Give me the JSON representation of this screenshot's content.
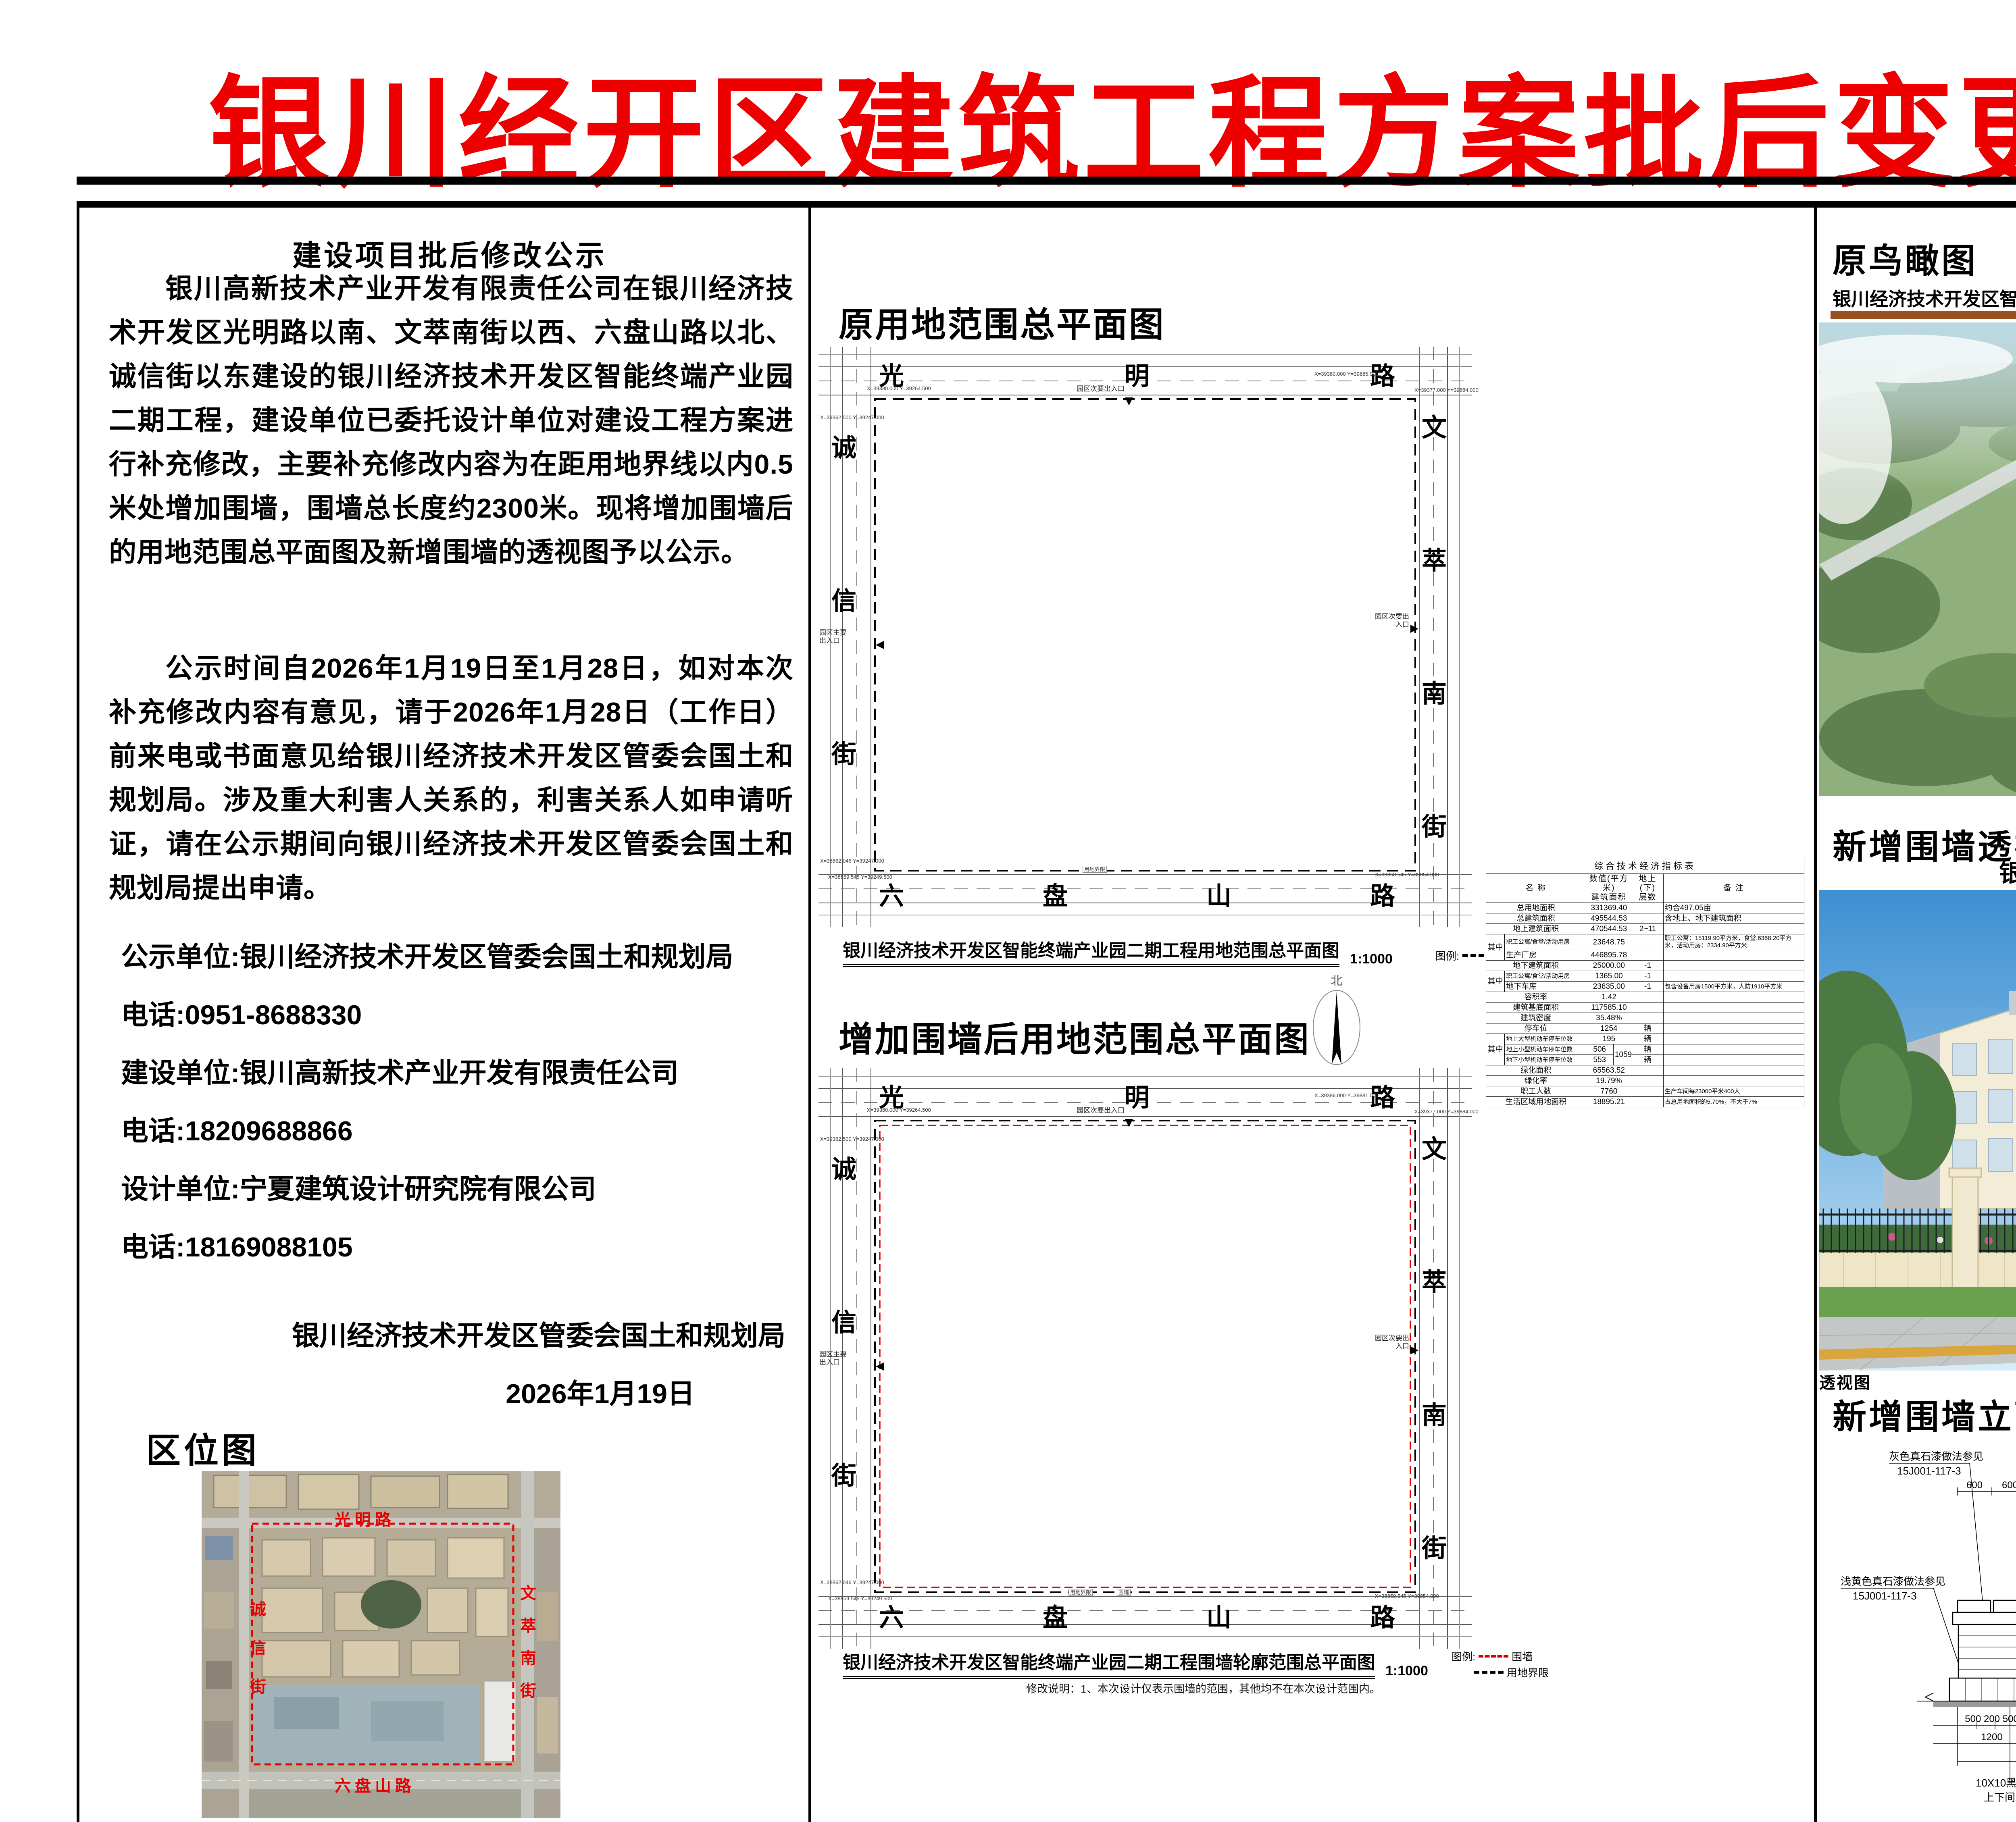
{
  "title": "银川经开区建筑工程方案批后变更公示图",
  "roads": {
    "guangming": "光明路",
    "chengxin": "诚信街",
    "wencui": "文萃南街",
    "liupanshan": "六盘山路"
  },
  "left": {
    "notice_title": "建设项目批后修改公示",
    "para1": "银川高新技术产业开发有限责任公司在银川经济技术开发区光明路以南、文萃南街以西、六盘山路以北、诚信街以东建设的银川经济技术开发区智能终端产业园二期工程，建设单位已委托设计单位对建设工程方案进行补充修改，主要补充修改内容为在距用地界线以内0.5米处增加围墙，围墙总长度约2300米。现将增加围墙后的用地范围总平面图及新增围墙的透视图予以公示。",
    "para2": "公示时间自2026年1月19日至1月28日，如对本次补充修改内容有意见，请于2026年1月28日（工作日）前来电或书面意见给银川经济技术开发区管委会国土和规划局。涉及重大利害人关系的，利害关系人如申请听证，请在公示期间向银川经济技术开发区管委会国土和规划局提出申请。",
    "publisher": "公示单位:银川经济技术开发区管委会国土和规划局",
    "publisher_tel": "电话:0951-8688330",
    "builder": "建设单位:银川高新技术产业开发有限责任公司",
    "builder_tel": "电话:18209688866",
    "designer": "设计单位:宁夏建筑设计研究院有限公司",
    "designer_tel": "电话:18169088105",
    "signoff_org": "银川经济技术开发区管委会国土和规划局",
    "signoff_date": "2026年1月19日",
    "locmap_heading": "区位图"
  },
  "plan1": {
    "heading": "原用地范围总平面图",
    "caption": "银川经济技术开发区智能终端产业园二期工程用地范围总平面图",
    "scale": "1:1000",
    "legend_label": "图例:",
    "legend_boundary": "用地界限",
    "entrance_top": "园区次要出入口",
    "entrance_right": "园区次要出入口",
    "entrance_left": "园区主要出入口",
    "boundary_label": "用地界限",
    "coord_tl": "X=39380.000 Y=39264.500",
    "coord_tl2": "X=39362.500 Y=39247.000",
    "coord_tr": "X=39380.000 Y=39885.000",
    "coord_tr2": "X=39377.000 Y=39884.000",
    "coord_bl": "X=38862.046 Y=39247.000",
    "coord_bl2": "X=38859.545 Y=39249.500",
    "coord_br": "X=38858.545 Y=39854.000"
  },
  "north_label": "北",
  "plan2": {
    "heading": "增加围墙后用地范围总平面图",
    "caption": "银川经济技术开发区智能终端产业园二期工程围墙轮廓范围总平面图",
    "scale": "1:1000",
    "legend_label": "图例:",
    "legend_wall": "围墙",
    "legend_boundary": "用地界限",
    "note": "修改说明：1、本次设计仅表示围墙的范围，其他均不在本次设计范围内。",
    "wall_label": "围墙",
    "entrance_top": "园区次要出入口",
    "entrance_right": "园区次要出入口",
    "entrance_left": "园区主要出入口",
    "boundary_label": "用地界限",
    "coord_tl": "X=39380.000 Y=39264.500",
    "coord_tl2": "X=39362.500 Y=39247.000",
    "coord_tr": "X=39386.000 Y=39881.000",
    "coord_tr2": "X=39377.000 Y=39884.000",
    "coord_bl": "X=38862.046 Y=39247.000",
    "coord_bl2": "X=38859.545 Y=39249.500",
    "coord_br": "X=38859.545 Y=39854.000"
  },
  "indicator_table": {
    "title": "综合技术经济指标表",
    "h_name": "名    称",
    "h_value": "数值(平方米)\n建筑面积",
    "h_floors": "地上(下)\n层数",
    "h_remark": "备    注",
    "rows": [
      [
        {
          "t": "总用地面积",
          "cs": 2
        },
        {
          "t": "331369.40",
          "cs": 2
        },
        {
          "t": ""
        },
        {
          "t": "约合497.05亩",
          "al": "l"
        }
      ],
      [
        {
          "t": "总建筑面积",
          "cs": 2
        },
        {
          "t": "495544.53",
          "cs": 2
        },
        {
          "t": ""
        },
        {
          "t": "含地上、地下建筑面积",
          "al": "l"
        }
      ],
      [
        {
          "t": "地上建筑面积",
          "cs": 2
        },
        {
          "t": "470544.53",
          "cs": 2
        },
        {
          "t": "2~11"
        },
        {
          "t": ""
        }
      ],
      [
        {
          "t": "其中",
          "rs": 2
        },
        {
          "t": "职工公寓/食堂/活动用房",
          "al": "l",
          "cls": "small"
        },
        {
          "t": "23648.75",
          "cs": 2
        },
        {
          "t": ""
        },
        {
          "t": "职工公寓：15119.90平方米，食堂:6368.20平方米，活动用房：2334.90平方米.",
          "al": "l",
          "cls": "small"
        }
      ],
      [
        {
          "t": "生产厂房",
          "al": "l"
        },
        {
          "t": "446895.78",
          "cs": 2
        },
        {
          "t": ""
        },
        {
          "t": ""
        }
      ],
      [
        {
          "t": "地下建筑面积",
          "cs": 2
        },
        {
          "t": "25000.00",
          "cs": 2
        },
        {
          "t": "-1"
        },
        {
          "t": ""
        }
      ],
      [
        {
          "t": "其中",
          "rs": 2
        },
        {
          "t": "职工公寓/食堂/活动用房",
          "al": "l",
          "cls": "small"
        },
        {
          "t": "1365.00",
          "cs": 2
        },
        {
          "t": "-1"
        },
        {
          "t": ""
        }
      ],
      [
        {
          "t": "地下车库",
          "al": "l"
        },
        {
          "t": "23635.00",
          "cs": 2
        },
        {
          "t": "-1"
        },
        {
          "t": "包含设备用房1500平方米，人防1910平方米",
          "al": "l",
          "cls": "small"
        }
      ],
      [
        {
          "t": "容积率",
          "cs": 2
        },
        {
          "t": "1.42",
          "cs": 2
        },
        {
          "t": ""
        },
        {
          "t": ""
        }
      ],
      [
        {
          "t": "建筑基底面积",
          "cs": 2
        },
        {
          "t": "117585.10",
          "cs": 2
        },
        {
          "t": ""
        },
        {
          "t": ""
        }
      ],
      [
        {
          "t": "建筑密度",
          "cs": 2
        },
        {
          "t": "35.48%",
          "cs": 2
        },
        {
          "t": ""
        },
        {
          "t": ""
        }
      ],
      [
        {
          "t": "停车位",
          "cs": 2
        },
        {
          "t": "1254",
          "cs": 2
        },
        {
          "t": "辆"
        },
        {
          "t": ""
        }
      ],
      [
        {
          "t": "其中",
          "rs": 3
        },
        {
          "t": "地上大型机动车停车位数",
          "al": "l",
          "cls": "small"
        },
        {
          "t": "195",
          "cs": 2
        },
        {
          "t": "辆"
        },
        {
          "t": ""
        }
      ],
      [
        {
          "t": "地上小型机动车停车位数",
          "al": "l",
          "cls": "small"
        },
        {
          "t": "506"
        },
        {
          "t": "1059",
          "rs": 2
        },
        {
          "t": "辆"
        },
        {
          "t": ""
        }
      ],
      [
        {
          "t": "地下小型机动车停车位数",
          "al": "l",
          "cls": "small"
        },
        {
          "t": "553"
        },
        {
          "t": "辆"
        },
        {
          "t": ""
        }
      ],
      [
        {
          "t": "绿化面积",
          "cs": 2
        },
        {
          "t": "65563.52",
          "cs": 2
        },
        {
          "t": ""
        },
        {
          "t": ""
        }
      ],
      [
        {
          "t": "绿化率",
          "cs": 2
        },
        {
          "t": "19.79%",
          "cs": 2
        },
        {
          "t": ""
        },
        {
          "t": ""
        }
      ],
      [
        {
          "t": "职工人数",
          "cs": 2
        },
        {
          "t": "7760",
          "cs": 2
        },
        {
          "t": ""
        },
        {
          "t": "生产车间每23000平米400人",
          "al": "l",
          "cls": "small"
        }
      ],
      [
        {
          "t": "生活区域用地面积",
          "cs": 2
        },
        {
          "t": "18895.21",
          "cs": 2
        },
        {
          "t": ""
        },
        {
          "t": "占总用地面积的5.70%，不大于7%",
          "al": "l",
          "cls": "small"
        }
      ]
    ]
  },
  "right": {
    "aerial_heading": "原鸟瞰图",
    "aerial_caption": "银川经济技术开发区智能终端产业园二期工程",
    "accent_color": "#9a4f21",
    "persp_heading": "新增围墙透视图",
    "persp_title": "银川经济技术开发区智能终端产业园二期围墙设计方案",
    "persp_pinyin": "YINCHUANJINGJIJISHUKAIFAQUZHINENGZHONGDUANCHANYEYUANERQIWEIQIANGSHIJIFANGAN",
    "persp_ann1": "灰色真石漆",
    "persp_ann1_code": "CBCC 1264 10B 5.25/1",
    "persp_ann2": "浅黄色真石漆",
    "persp_ann2_code": "CBCC 1493 3.1YR 9/3.2",
    "persp_view_label": "透视图",
    "elev_heading": "新增围墙立面图",
    "elevation": {
      "ann_gray_1": "灰色真石漆做法参见",
      "ann_gray_2": "15J001-117-3",
      "ann_yellow_1": "浅黄色真石漆做法参见",
      "ann_yellow_2": "15J001-117-3",
      "ann_post_1": "立柱采用60X60方钢管黑油漆",
      "ann_post_2": "厚度1.5",
      "ann_40_1": "40X40方钢管黑油漆",
      "ann_40_2": "厚度1.0",
      "ann_20_1": "20X20方钢管黑油漆，厚度0.8",
      "ann_20_2": "方钢管及钢管之间花式由甲方自理",
      "ann_jointv_1": "10X10黑色勾缝",
      "ann_jointv_2": "上下间距300",
      "ann_jointh_1": "10X10黑色勾缝",
      "ann_jointh_2": "左右间距300",
      "ann_yellow2_1": "浅黄色真石漆做法参见",
      "ann_yellow2_2": "15J001-117-3",
      "d600a": "600",
      "d600b": "600",
      "d100": "100",
      "d1200": "1200",
      "d1000": "1000",
      "d400": "400",
      "dcluster1": "100 120 200",
      "dcluster2": "380  380",
      "dcluster3": "120",
      "dr200a": "200",
      "dr200b": "200",
      "dr1400": "1400",
      "dr400": "400",
      "dr2200": "2200",
      "b1a": "500 200 500",
      "b1b": "3000",
      "b1c": "3000",
      "b1d": "500 200 500",
      "b2a": "1200",
      "b2b": "3000",
      "b2c": "3000",
      "b2d": "1200",
      "b3": "8400"
    }
  }
}
